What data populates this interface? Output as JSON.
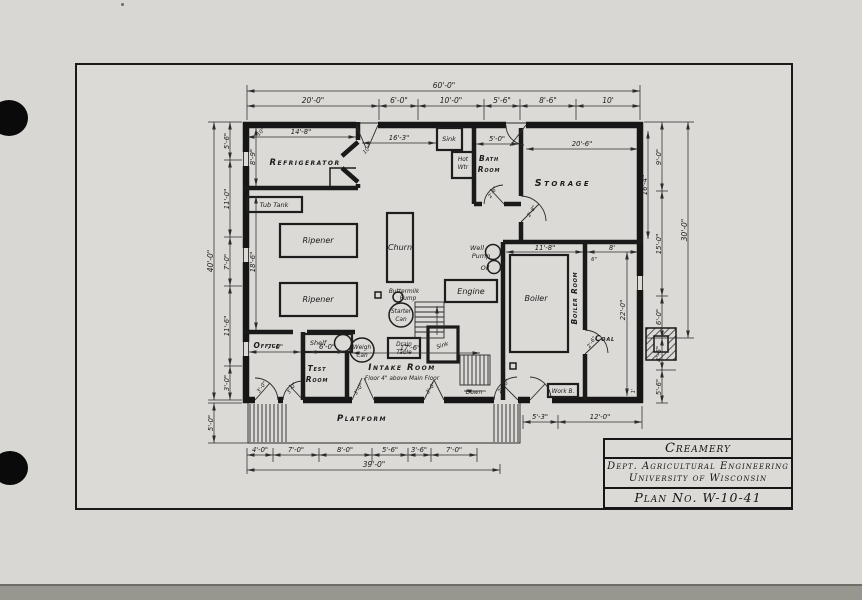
{
  "colors": {
    "ink": "#1a1a1a",
    "paper": "#d8d7d3"
  },
  "title_block": {
    "project": "Creamery",
    "dept": "Dept. Agricultural Engineering",
    "univ": "University of Wisconsin",
    "plan_no": "Plan No. W-10-41"
  },
  "rooms": {
    "refrigerator": "Refrigerator",
    "storage": "Storage",
    "bath_1": "Bath",
    "bath_2": "Room",
    "office": "Office",
    "test_1": "Test",
    "test_2": "Room",
    "intake": "Intake Room",
    "intake_sub": "Floor 4\" above Main Floor",
    "boiler_room": "Boiler Room",
    "coal": "Coal",
    "platform": "Platform"
  },
  "equipment": {
    "tub_tank": "Tub Tank",
    "ripener": "Ripener",
    "churn": "Churn",
    "sink": "Sink",
    "hot": "Hot",
    "wtr": "Wtr",
    "well": "Well",
    "pump": "Pump",
    "oil": "Oil",
    "engine": "Engine",
    "buttermilk": "Buttermilk",
    "starter": "Starter",
    "can": "Can",
    "boiler": "Boiler",
    "shelf": "Shelf",
    "weigh": "Weigh",
    "drain": "Drain",
    "table": "Table",
    "down": "Down",
    "work_b": "Work B."
  },
  "dims": {
    "top_total": "60'-0\"",
    "top_1": "20'-0\"",
    "top_2": "6'-0\"",
    "top_3": "10'-0\"",
    "top_4": "5'-6\"",
    "top_5": "8'-6\"",
    "top_6": "10'",
    "ref_w": "14'-8\"",
    "mid_w": "16'-3\"",
    "bath_w": "5'-0\"",
    "storage_w": "20'-6\"",
    "left_total": "40'-0\"",
    "left_1": "5'-6\"",
    "left_2": "11'-0\"",
    "left_3": "7'-0\"",
    "left_4": "11'-6\"",
    "left_5": "3'-0\"",
    "ref_h": "8'-9\"",
    "left_mid": "18'-6\"",
    "platform_h": "5'-0\"",
    "right_total": "30'-0\"",
    "right_1": "9'-0\"",
    "right_2": "15'-0\"",
    "right_3": "6'-0\"",
    "right_4": "4'-6\"",
    "right_5": "5'-6\"",
    "storage_h": "16'-4\"",
    "coal_h": "22'-0\"",
    "boiler_w": "11'-8\"",
    "coal_w": "8'",
    "six_in": "6\"",
    "one_ft": "1'",
    "bottom_total": "39'-0\"",
    "bot_1": "4'-0\"",
    "bot_2": "7'-0\"",
    "bot_3": "8'-0\"",
    "bot_4": "5'-6\"",
    "bot_5": "3'-6\"",
    "bot_6": "7'-0\"",
    "br_1": "5'-3\"",
    "br_2": "12'-0\"",
    "office_w": "7'-0\"",
    "test_w": "6'-0\"",
    "intake_w": "17'-6\"",
    "wall_10": "10\""
  },
  "doors": {
    "d26": "2'-6\"",
    "d28": "2'-8\"",
    "d30": "3'-0\"",
    "d210": "2'-10\""
  }
}
